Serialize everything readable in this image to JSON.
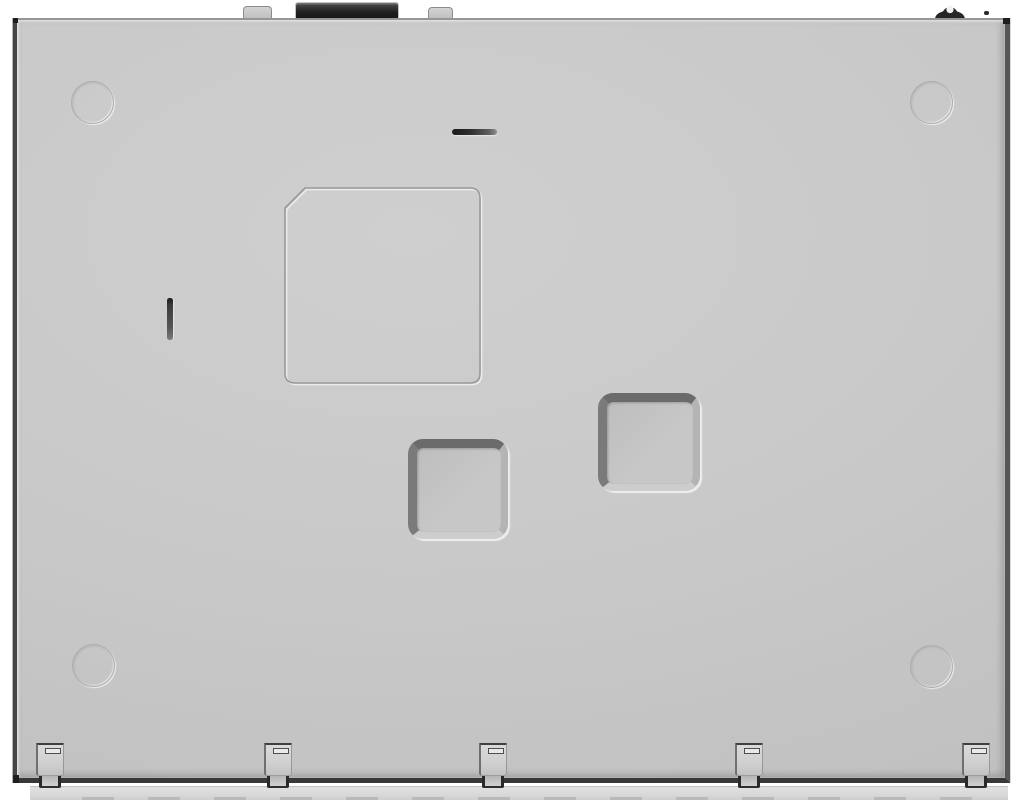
{
  "scene": {
    "width": 1024,
    "height": 800
  },
  "palette": {
    "background": "#ffffff",
    "face": "#c8c8c8",
    "face-light": "#cfcfcf",
    "face-dark": "#bfbfbf",
    "edge-top": "#969696",
    "edge-left": "#454545",
    "edge-right": "#565656",
    "edge-bottom": "#383838",
    "circle-line": "#aeaeae",
    "groove-dark": "#9a9a9a",
    "groove-light": "#ebebeb",
    "recess-dark": "#6b6b6b",
    "recess-mid": "#7a7a7a",
    "recess-light-side": "#b4b4b4",
    "recess-light-bottom": "#cdcdcd",
    "slot-dark": "#1c1c1c",
    "slot-mid": "#555555",
    "connector-dark": "#1f1f1f",
    "connector-light": "#4f4f4f",
    "tab-face": "#d3d3d3",
    "tab-edge": "#8b8b8b",
    "clip-dark": "#3f3f3f",
    "clip-face": "#d0d0d0",
    "rail-face": "#d9d9d9",
    "rail-dash": "#a6a6a6",
    "screw-dark": "#262626"
  },
  "features": {
    "top_edge_tabs": [
      {
        "x": 243,
        "y": 6,
        "w": 29,
        "h": 14
      },
      {
        "x": 428,
        "y": 7,
        "w": 25,
        "h": 13
      }
    ],
    "emboss_circles": [
      {
        "x": 71,
        "y": 81,
        "d": 43
      },
      {
        "x": 910,
        "y": 81,
        "d": 43
      },
      {
        "x": 72,
        "y": 644,
        "d": 43
      },
      {
        "x": 910,
        "y": 645,
        "d": 43
      }
    ],
    "square_recesses": [
      {
        "x": 408,
        "y": 439,
        "w": 100,
        "h": 100
      },
      {
        "x": 598,
        "y": 393,
        "w": 102,
        "h": 98
      }
    ],
    "slots": [
      {
        "x": 167,
        "y": 298,
        "w": 6,
        "h": 42,
        "orientation": "vertical"
      },
      {
        "x": 452,
        "y": 129,
        "w": 45,
        "h": 6,
        "orientation": "horizontal"
      }
    ],
    "bottom_clips": [
      {
        "x": 36
      },
      {
        "x": 264
      },
      {
        "x": 479
      },
      {
        "x": 735
      },
      {
        "x": 962
      }
    ]
  }
}
